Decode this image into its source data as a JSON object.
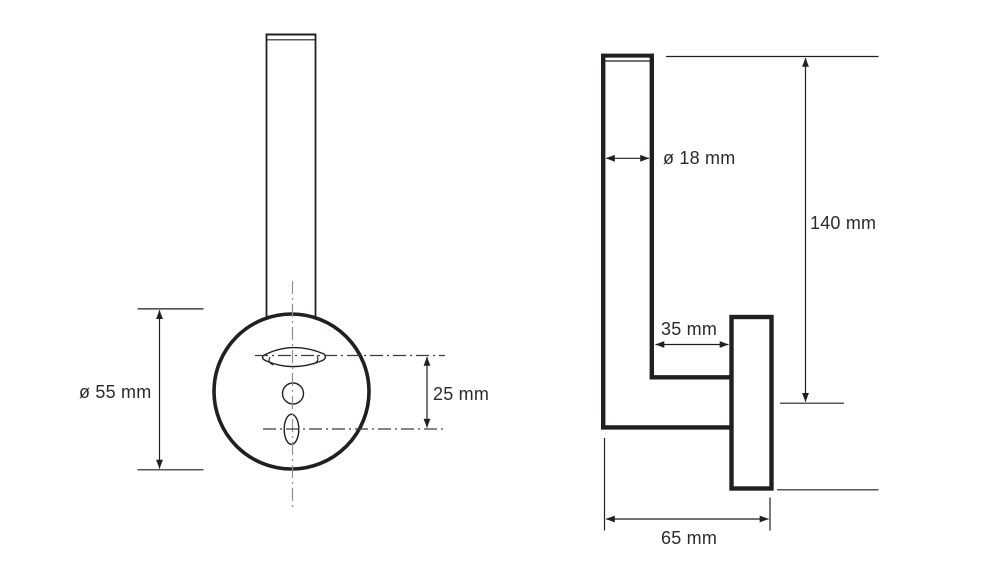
{
  "drawing": {
    "type": "product-dimension-diagram",
    "units": "mm",
    "colors": {
      "background": "#ffffff",
      "line": "#231f20",
      "centerline": "#8f8f8f",
      "text": "#2b2b2b"
    },
    "views": {
      "front": {
        "name": "front-view",
        "parts": [
          "rod",
          "mounting-plate-circle",
          "keyhole-slot",
          "screw-hole",
          "bottom-slot"
        ],
        "dimensions": [
          {
            "id": "plate-diameter",
            "label": "ø 55 mm",
            "value": 55
          },
          {
            "id": "hole-spacing",
            "label": "25 mm",
            "value": 25
          }
        ]
      },
      "side": {
        "name": "side-view",
        "parts": [
          "tube",
          "arm",
          "wall-plate"
        ],
        "dimensions": [
          {
            "id": "tube-diameter",
            "label": "ø 18 mm",
            "value": 18
          },
          {
            "id": "height",
            "label": "140 mm",
            "value": 140
          },
          {
            "id": "arm-depth",
            "label": "35 mm",
            "value": 35
          },
          {
            "id": "total-depth",
            "label": "65 mm",
            "value": 65
          }
        ]
      }
    }
  }
}
